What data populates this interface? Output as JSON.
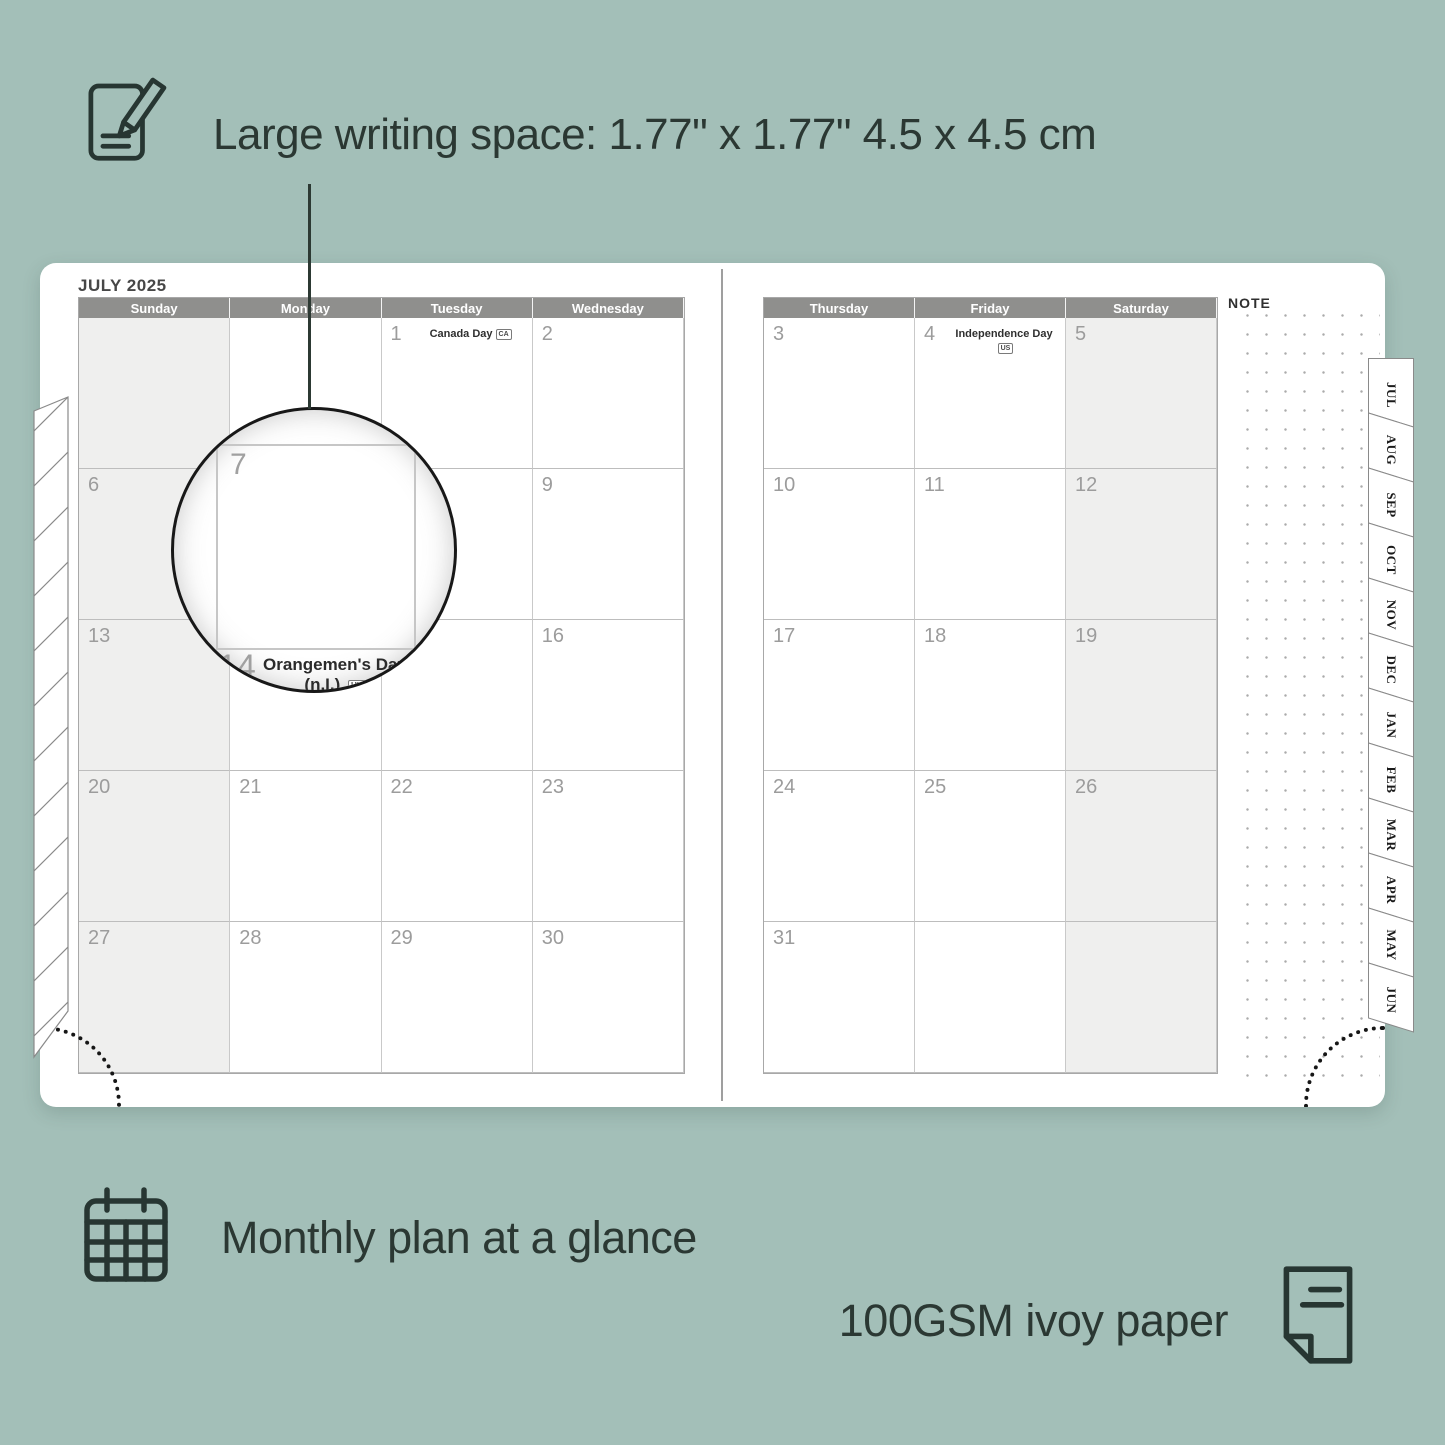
{
  "colors": {
    "background": "#a3bfb8",
    "header_gray": "#8f8f8d",
    "shaded_cell": "#efefee",
    "accent_dark": "#2b3833"
  },
  "top_caption": {
    "text": "Large writing space: 1.77\" x 1.77\"  4.5 x 4.5 cm"
  },
  "planner": {
    "title": "JULY 2025",
    "note_label": "NOTE",
    "left_page": {
      "day_headers": [
        "Sunday",
        "Monday",
        "Tuesday",
        "Wednesday"
      ],
      "shaded_col": 0,
      "weeks": [
        [
          {
            "day": ""
          },
          {
            "day": ""
          },
          {
            "day": "1",
            "holiday": "Canada Day",
            "badge": "CA"
          },
          {
            "day": "2"
          }
        ],
        [
          {
            "day": "6"
          },
          {
            "day": "7"
          },
          {
            "day": "8"
          },
          {
            "day": "9"
          }
        ],
        [
          {
            "day": "13"
          },
          {
            "day": "14",
            "holiday": "Orangemen's Day (n.I.)",
            "badge": "UK"
          },
          {
            "day": "15"
          },
          {
            "day": "16"
          }
        ],
        [
          {
            "day": "20"
          },
          {
            "day": "21"
          },
          {
            "day": "22"
          },
          {
            "day": "23"
          }
        ],
        [
          {
            "day": "27"
          },
          {
            "day": "28"
          },
          {
            "day": "29"
          },
          {
            "day": "30"
          }
        ]
      ]
    },
    "right_page": {
      "day_headers": [
        "Thursday",
        "Friday",
        "Saturday"
      ],
      "shaded_col": 2,
      "weeks": [
        [
          {
            "day": "3"
          },
          {
            "day": "4",
            "holiday": "Independence Day",
            "badge": "US"
          },
          {
            "day": "5"
          }
        ],
        [
          {
            "day": "10"
          },
          {
            "day": "11"
          },
          {
            "day": "12"
          }
        ],
        [
          {
            "day": "17"
          },
          {
            "day": "18"
          },
          {
            "day": "19"
          }
        ],
        [
          {
            "day": "24"
          },
          {
            "day": "25"
          },
          {
            "day": "26"
          }
        ],
        [
          {
            "day": "31"
          },
          {
            "day": ""
          },
          {
            "day": ""
          }
        ]
      ]
    },
    "tabs": [
      "JUL",
      "AUG",
      "SEP",
      "OCT",
      "NOV",
      "DEC",
      "JAN",
      "FEB",
      "MAR",
      "APR",
      "MAY",
      "JUN"
    ],
    "magnifier": {
      "day": "7",
      "below_day": "14",
      "holiday_line1": "Orangemen's Day",
      "holiday_line2": "(n.I.)",
      "badge": "UK"
    }
  },
  "bottom_captions": {
    "monthly": "Monthly plan at a glance",
    "paper": "100GSM ivoy paper"
  }
}
